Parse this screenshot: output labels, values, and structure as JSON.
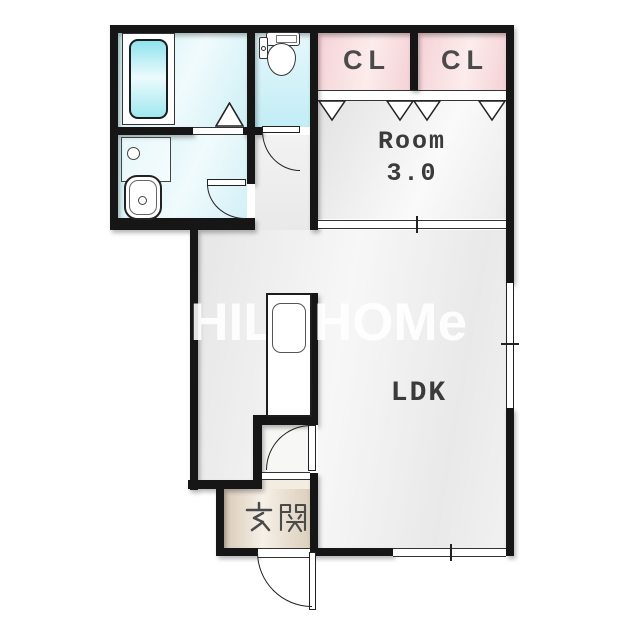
{
  "floorplan": {
    "watermark": "CHILDHOMe",
    "closet_left": {
      "label": "CL"
    },
    "closet_right": {
      "label": "CL"
    },
    "bedroom": {
      "name": "Room",
      "size": "3.0"
    },
    "ldk": {
      "label": "LDK"
    },
    "entrance": {
      "label": "玄関"
    },
    "fixtures": [
      "bathtub",
      "toilet",
      "washbasin",
      "washing-machine-pan",
      "kitchen-counter",
      "kitchen-sink",
      "sliding-door",
      "folding-closet-doors",
      "swing-doors",
      "bath-folding-door",
      "windows"
    ],
    "colors": {
      "wall": "#161616",
      "wet_area_floor": "#d6f1f7",
      "bathtub": "#9fe7f0",
      "closet": "#f6d5d9",
      "room_floor": "#ececec",
      "genkan_floor": "#e9dccb",
      "label_text": "#424242",
      "watermark_text": "#ffffff"
    }
  }
}
